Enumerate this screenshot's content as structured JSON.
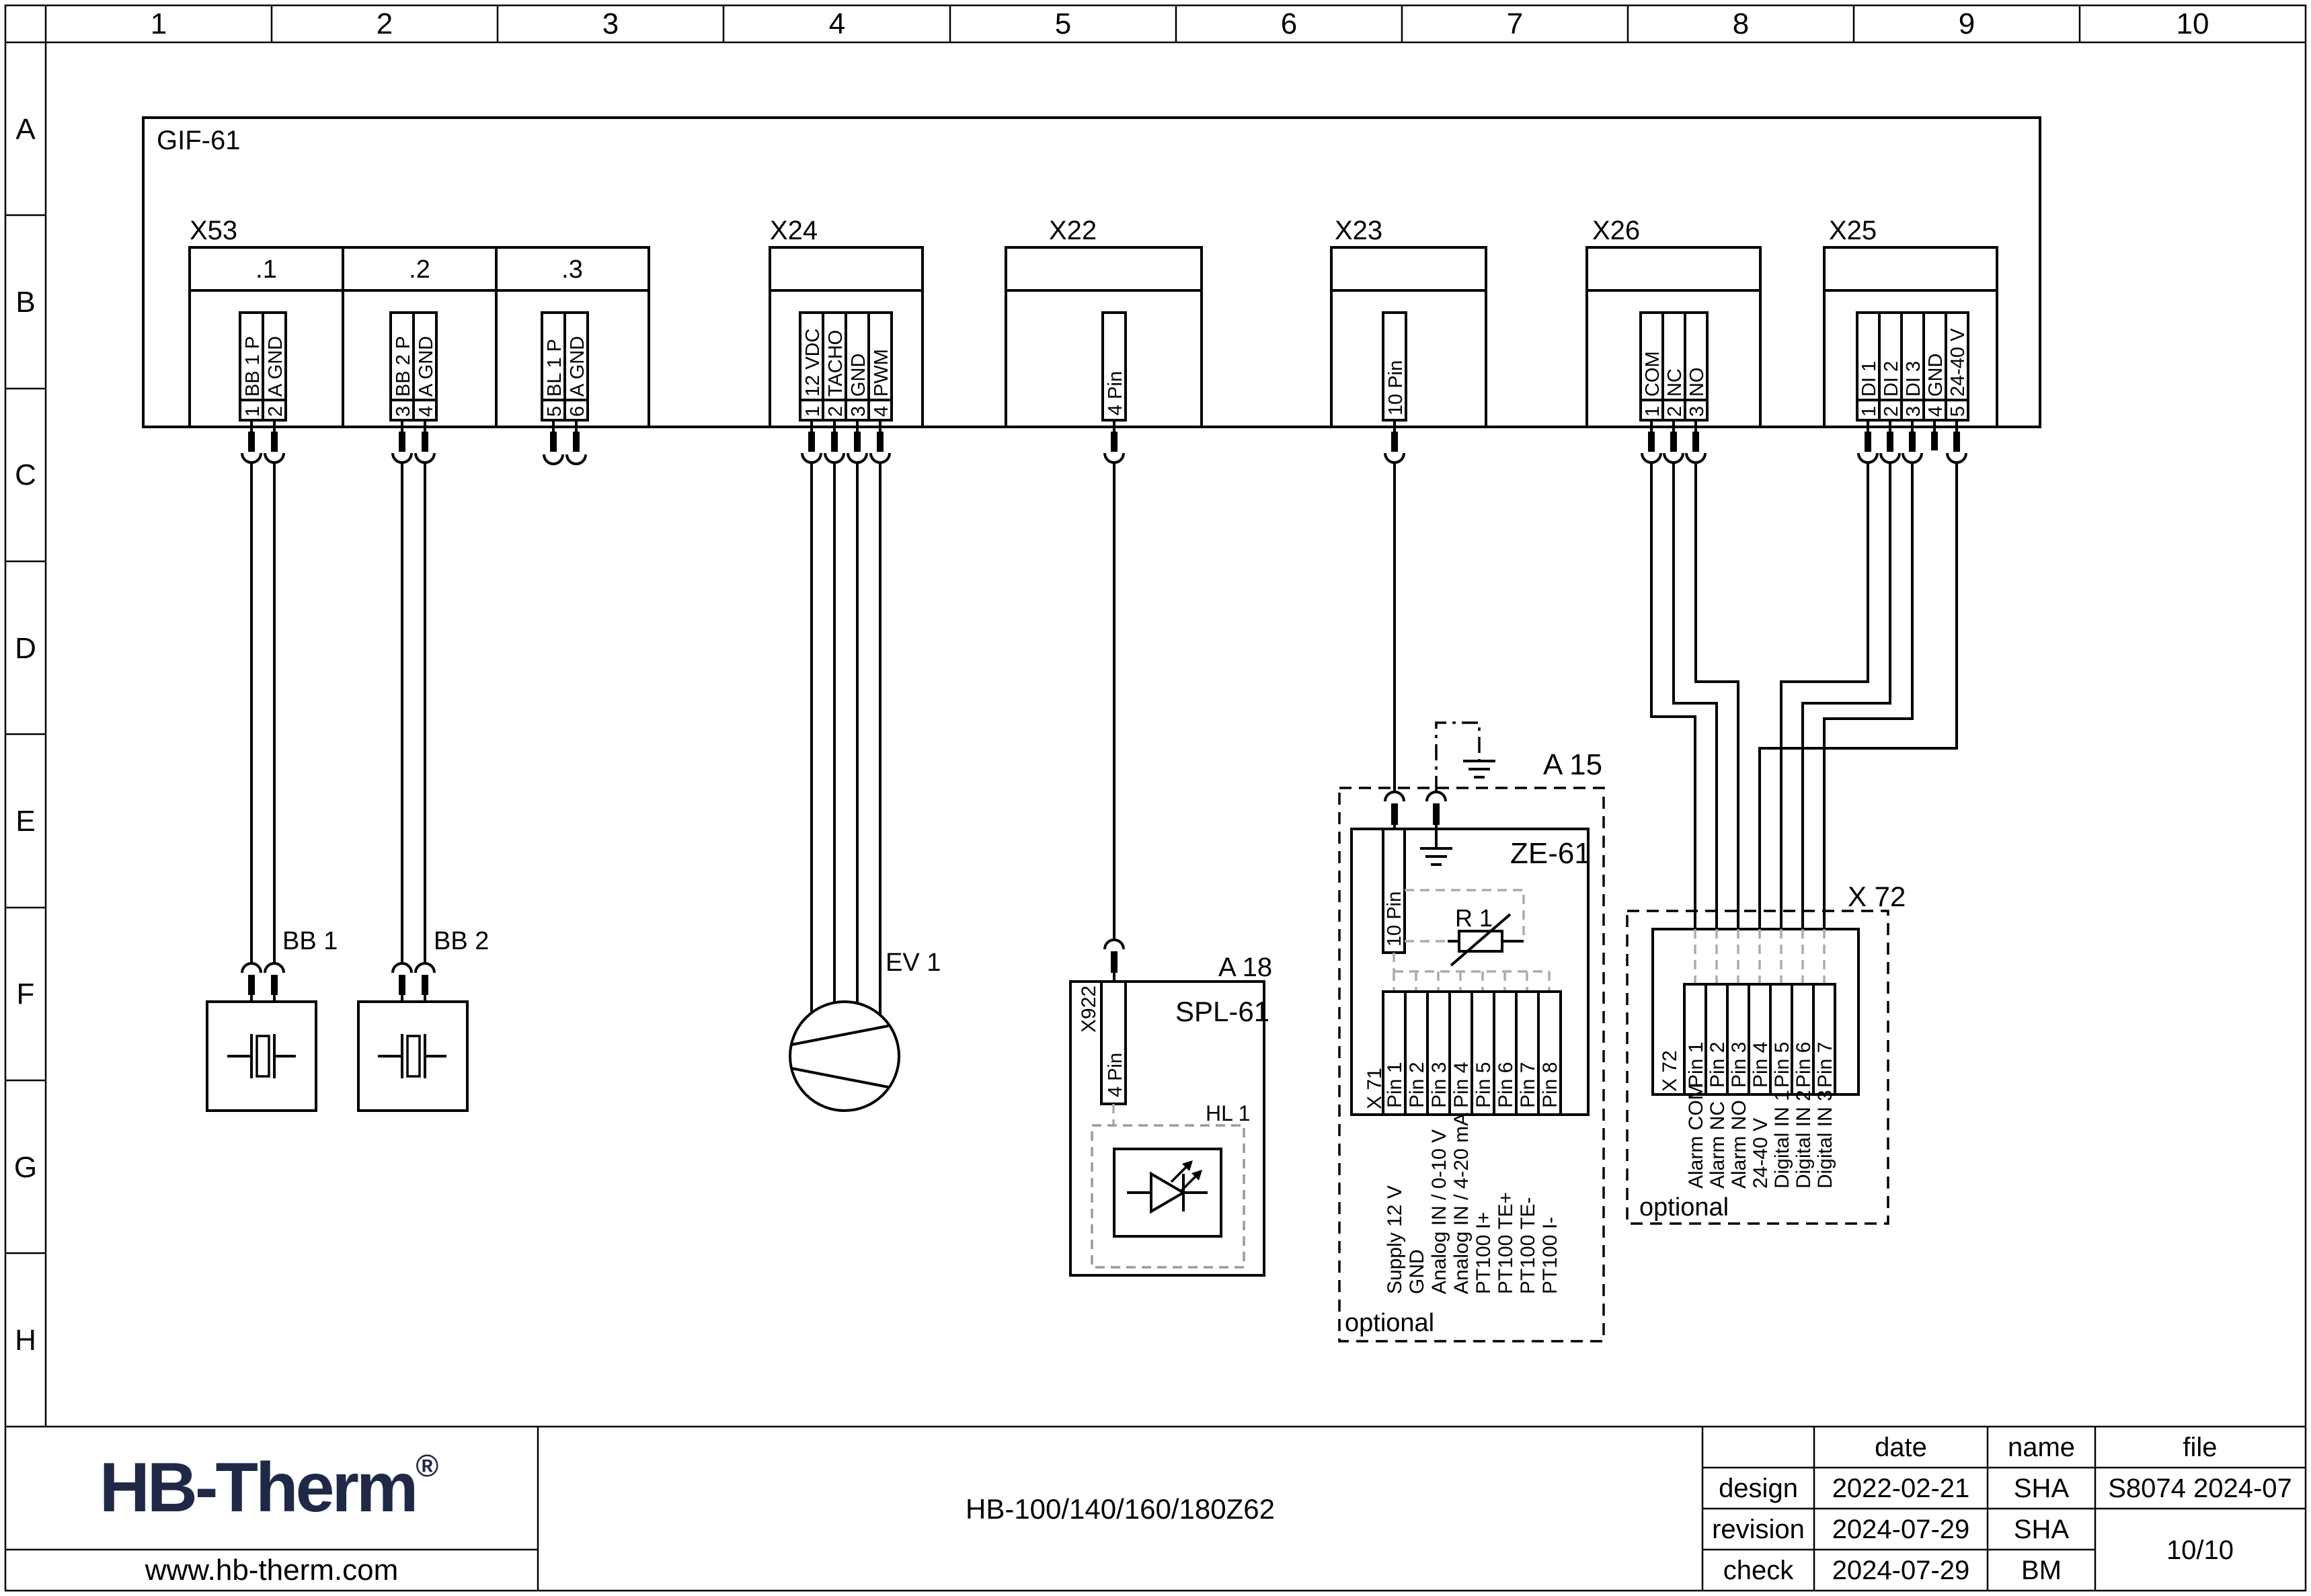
{
  "ruler": {
    "columns": [
      "1",
      "2",
      "3",
      "4",
      "5",
      "6",
      "7",
      "8",
      "9",
      "10"
    ],
    "rows": [
      "A",
      "B",
      "C",
      "D",
      "E",
      "F",
      "G",
      "H"
    ]
  },
  "board": {
    "label": "GIF-61"
  },
  "connectors": {
    "x53": {
      "label": "X53",
      "sections": [
        ".1",
        ".2",
        ".3"
      ],
      "pins": [
        {
          "n": "1",
          "t": "BB 1 P"
        },
        {
          "n": "2",
          "t": "A GND"
        },
        {
          "n": "3",
          "t": "BB 2 P"
        },
        {
          "n": "4",
          "t": "A GND"
        },
        {
          "n": "5",
          "t": "BL 1 P"
        },
        {
          "n": "6",
          "t": "A GND"
        }
      ]
    },
    "x24": {
      "label": "X24",
      "pins": [
        {
          "n": "1",
          "t": "12 VDC"
        },
        {
          "n": "2",
          "t": "TACHO"
        },
        {
          "n": "3",
          "t": "GND"
        },
        {
          "n": "4",
          "t": "PWM"
        }
      ]
    },
    "x22": {
      "label": "X22",
      "pin": "4 Pin"
    },
    "x23": {
      "label": "X23",
      "pin": "10 Pin"
    },
    "x26": {
      "label": "X26",
      "pins": [
        {
          "n": "1",
          "t": "COM"
        },
        {
          "n": "2",
          "t": "NC"
        },
        {
          "n": "3",
          "t": "NO"
        }
      ]
    },
    "x25": {
      "label": "X25",
      "pins": [
        {
          "n": "1",
          "t": "DI 1"
        },
        {
          "n": "2",
          "t": "DI 2"
        },
        {
          "n": "3",
          "t": "DI 3"
        },
        {
          "n": "4",
          "t": "GND"
        },
        {
          "n": "5",
          "t": "24-40 V"
        }
      ]
    }
  },
  "components": {
    "bb1": {
      "label": "BB 1"
    },
    "bb2": {
      "label": "BB 2"
    },
    "ev1": {
      "label": "EV 1"
    },
    "a18": {
      "label": "A 18",
      "module": "SPL-61",
      "connector": "X922",
      "connector_pin": "4 Pin",
      "lamp": "HL 1"
    },
    "a15": {
      "label": "A 15",
      "module": "ZE-61",
      "header": "10 Pin",
      "resistor": "R 1",
      "terminal": "X 71",
      "pins": [
        "Pin 1",
        "Pin 2",
        "Pin 3",
        "Pin 4",
        "Pin 5",
        "Pin 6",
        "Pin 7",
        "Pin 8"
      ],
      "functions": [
        "Supply 12 V",
        "GND",
        "Analog IN / 0-10 V",
        "Analog IN / 4-20 mA",
        "PT100 I+",
        "PT100 TE+",
        "PT100 TE-",
        "PT100 I-"
      ],
      "note": "optional"
    },
    "x72": {
      "label": "X 72",
      "terminal": "X 72",
      "pins": [
        "Pin 1",
        "Pin 2",
        "Pin 3",
        "Pin 4",
        "Pin 5",
        "Pin 6",
        "Pin 7"
      ],
      "functions": [
        "Alarm COM",
        "Alarm NC",
        "Alarm NO",
        "24-40 V",
        "Digital IN 1",
        "Digital IN 2",
        "Digital IN 3"
      ],
      "note": "optional"
    }
  },
  "title_block": {
    "logo": "HB-Therm",
    "logo_reg": "®",
    "logo_color": "#1f2947",
    "website": "www.hb-therm.com",
    "title": "HB-100/140/160/180Z62",
    "table": {
      "headers": {
        "date": "date",
        "name": "name",
        "file": "file"
      },
      "rows": [
        {
          "label": "design",
          "date": "2022-02-21",
          "name": "SHA"
        },
        {
          "label": "revision",
          "date": "2024-07-29",
          "name": "SHA"
        },
        {
          "label": "check",
          "date": "2024-07-29",
          "name": "BM"
        }
      ],
      "file_value": "S8074 2024-07",
      "page": "10/10"
    }
  }
}
